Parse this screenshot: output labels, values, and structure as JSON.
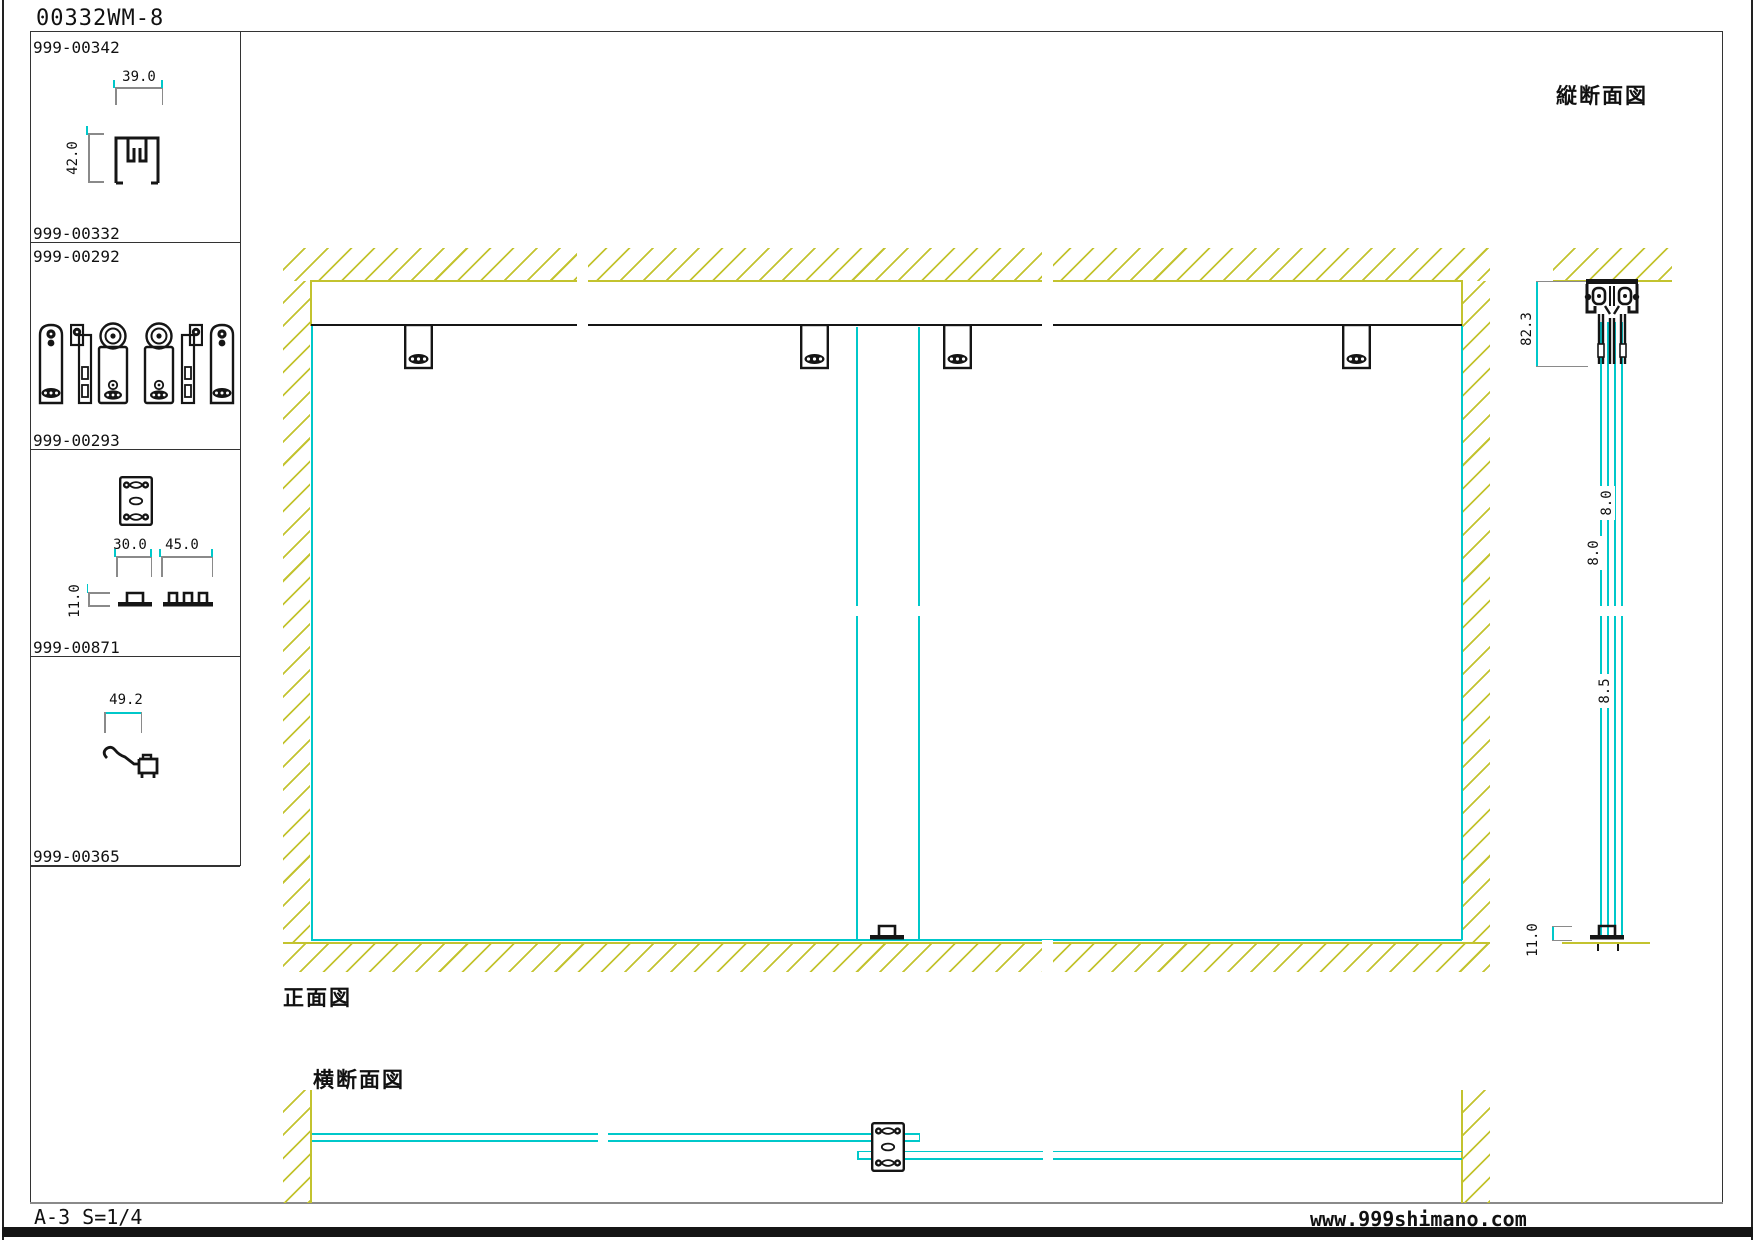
{
  "title": "00332WM-8",
  "sidebar": {
    "parts": [
      {
        "id": "999-00342",
        "dim_w": "39.0",
        "dim_h": "42.0"
      },
      {
        "id": "999-00332"
      },
      {
        "id": "999-00292"
      },
      {
        "id": "999-00293",
        "dim_w1": "30.0",
        "dim_w2": "45.0",
        "dim_h": "11.0"
      },
      {
        "id": "999-00871",
        "dim_w": "49.2"
      },
      {
        "id": "999-00365"
      }
    ]
  },
  "views": {
    "front": {
      "label": "正面図"
    },
    "vertical_section": {
      "label": "縦断面図",
      "dim_total": "82.3",
      "dim_glass_a": "8.0",
      "dim_glass_b": "8.0",
      "dim_gap": "8.5",
      "dim_floor": "11.0"
    },
    "horizontal_section": {
      "label": "横断面図"
    }
  },
  "footer": {
    "sheet_scale": "A-3 S=1/4",
    "website": "www.999shimano.com"
  },
  "colors": {
    "hatch": "#c3c32f",
    "glass": "#00c8ca",
    "line": "#151515",
    "dim_tick": "#8a8a8a"
  }
}
